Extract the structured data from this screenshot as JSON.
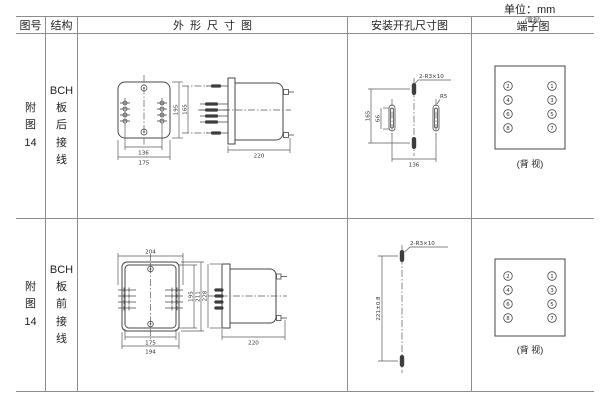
{
  "page": {
    "unit": "单位：mm"
  },
  "header": {
    "figure": "图号",
    "structure": "结构",
    "outline": "外形尺寸图",
    "mounting": "安装开孔尺寸图",
    "terminal": "端子图",
    "terminal_note": "(背视)"
  },
  "row1": {
    "figure": "附\n图\n14",
    "structure": "BCH\n板\n后\n接\n线",
    "outline": {
      "w_inner": "136",
      "w_outer": "175",
      "h": "195",
      "pin_span": "165",
      "depth": "220"
    },
    "mounting": {
      "slots": "2-R3×10",
      "radius": "R5",
      "h": "165",
      "slot_h": "66",
      "w": "136"
    },
    "terminal": {
      "left": [
        "2",
        "4",
        "6",
        "8"
      ],
      "right": [
        "1",
        "3",
        "5",
        "7"
      ],
      "caption": "(背 视)"
    }
  },
  "row2": {
    "figure": "附\n图\n14",
    "structure": "BCH\n板\n前\n接\n线",
    "outline": {
      "w_top": "204",
      "w_inner": "175",
      "w_outer": "194",
      "h_inner": "195",
      "h_outer": "211",
      "h_side": "228",
      "depth": "220"
    },
    "mounting": {
      "slots": "2-R3×10",
      "h": "221±0.8"
    },
    "terminal": {
      "left": [
        "2",
        "4",
        "6",
        "8"
      ],
      "right": [
        "1",
        "3",
        "5",
        "7"
      ],
      "caption": "(背 视)"
    }
  }
}
